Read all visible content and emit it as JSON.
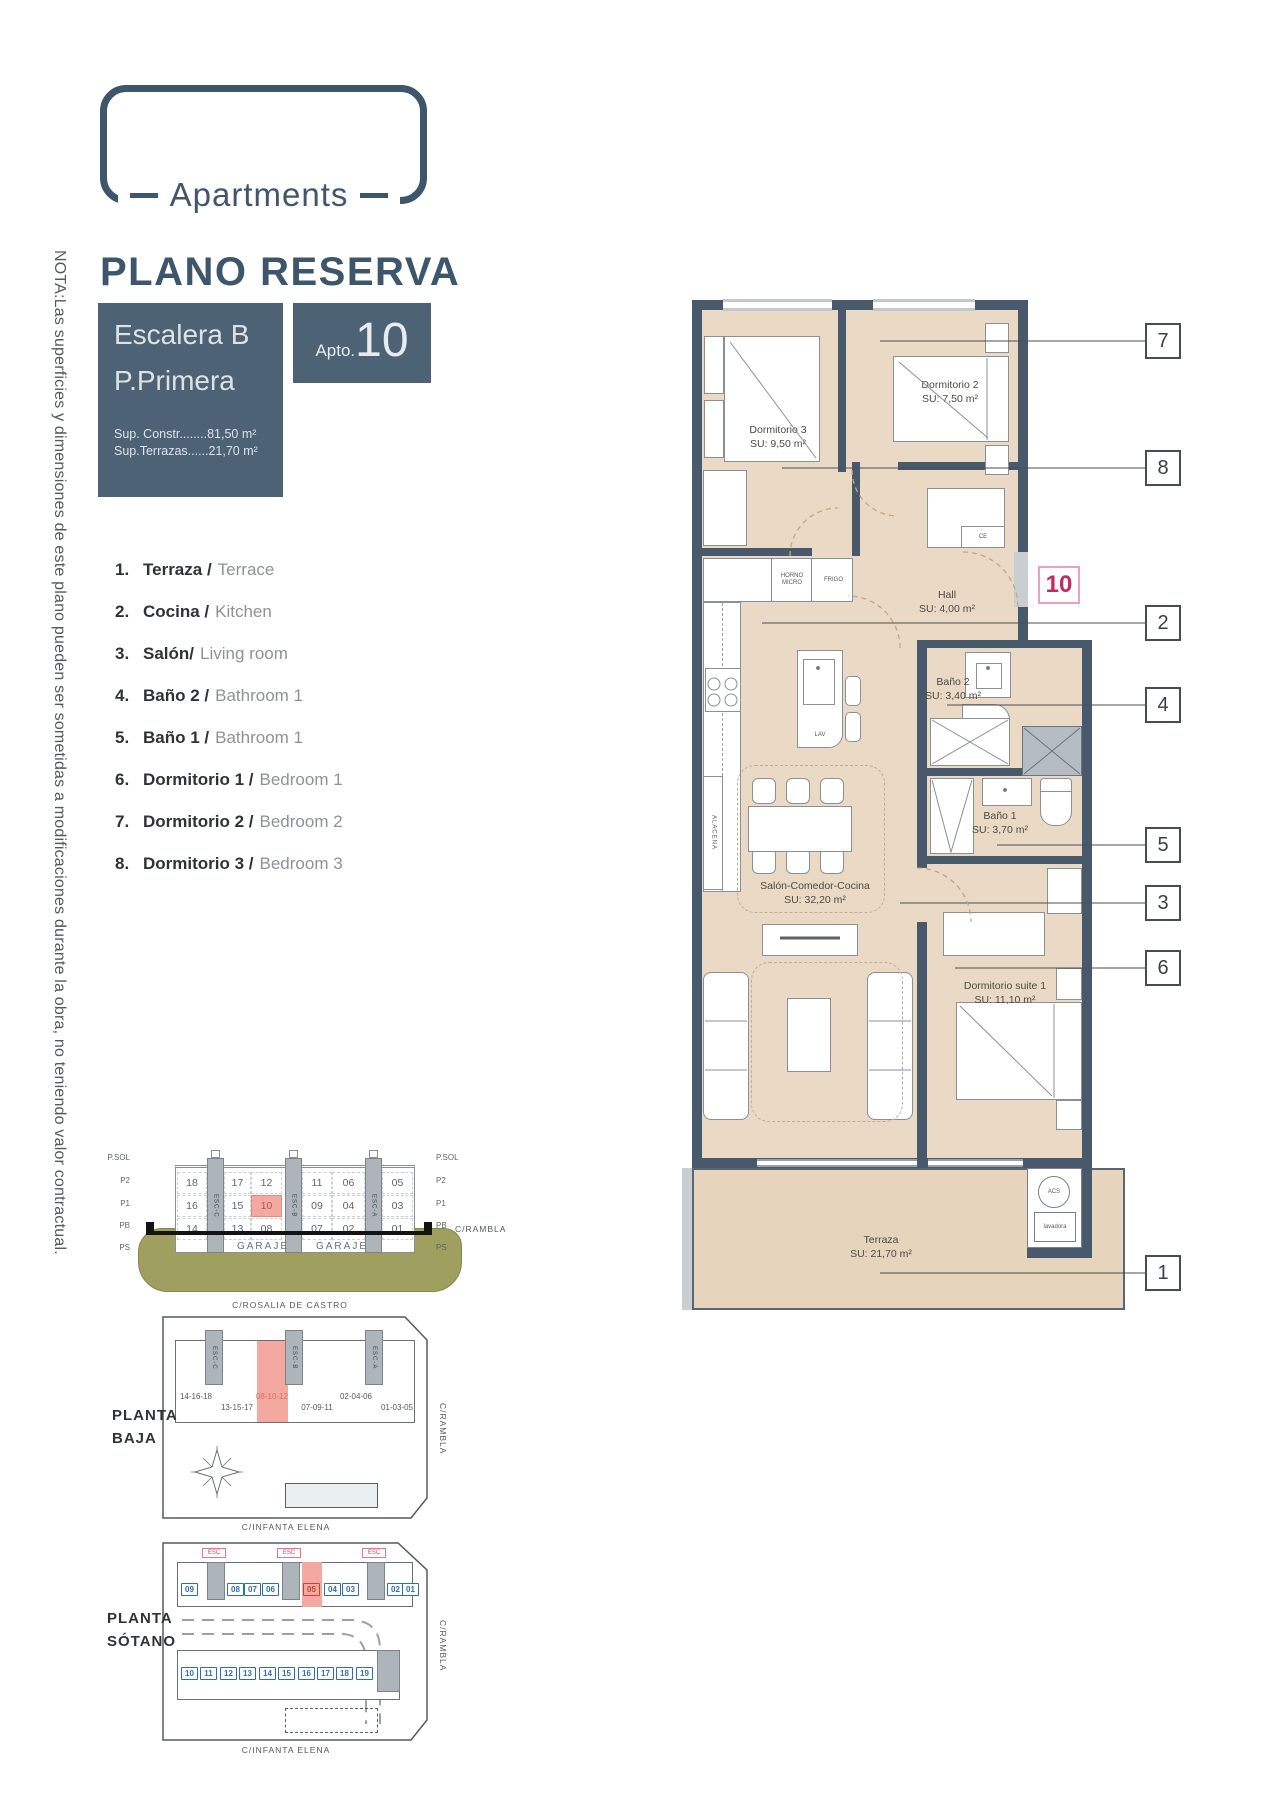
{
  "brand": {
    "logo_text": "Apartments",
    "title": "PLANO RESERVA"
  },
  "unit": {
    "escalera": "Escalera B",
    "planta": "P.Primera",
    "sup_constr": "Sup. Constr........81,50 m²",
    "sup_terrazas": "Sup.Terrazas......21,70 m²",
    "apto_label": "Apto.",
    "apto_number": "10"
  },
  "note": "NOTA:Las superficies y dimensiones de este plano pueden ser sometidas a modificaciones durante la obra, no teniendo valor contractual.",
  "legend": [
    {
      "n": "1.",
      "es": "Terraza /",
      "en": "Terrace"
    },
    {
      "n": "2.",
      "es": "Cocina /",
      "en": "Kitchen"
    },
    {
      "n": "3.",
      "es": "Salón/",
      "en": "Living room"
    },
    {
      "n": "4.",
      "es": "Baño 2 /",
      "en": "Bathroom 1"
    },
    {
      "n": "5.",
      "es": "Baño 1 /",
      "en": "Bathroom 1"
    },
    {
      "n": "6.",
      "es": "Dormitorio 1 /",
      "en": "Bedroom 1"
    },
    {
      "n": "7.",
      "es": "Dormitorio 2 /",
      "en": "Bedroom 2"
    },
    {
      "n": "8.",
      "es": "Dormitorio 3 /",
      "en": "Bedroom 3"
    }
  ],
  "plan": {
    "rooms": [
      {
        "name": "Dormitorio 3",
        "su": "SU: 9,50 m²"
      },
      {
        "name": "Dormitorio 2",
        "su": "SU: 7,50 m²"
      },
      {
        "name": "Hall",
        "su": "SU: 4,00 m²"
      },
      {
        "name": "Baño 2",
        "su": "SU: 3,40 m²"
      },
      {
        "name": "Baño 1",
        "su": "SU: 3,70 m²"
      },
      {
        "name": "Salón-Comedor-Cocina",
        "su": "SU: 32,20 m²"
      },
      {
        "name": "Dormitorio suite 1",
        "su": "SU: 11,10 m²"
      },
      {
        "name": "Terraza",
        "su": "SU: 21,70 m²"
      }
    ],
    "fixtures": {
      "horno": "HORNO MICRO",
      "frigo": "FRIGO",
      "lav": "LAV",
      "alacena": "ALACENA",
      "ce": "CE",
      "acs": "ACS",
      "lavadora": "lavadora"
    },
    "callouts": [
      "7",
      "8",
      "2",
      "4",
      "5",
      "3",
      "6",
      "1"
    ],
    "unit_number": "10"
  },
  "section": {
    "floors": [
      "P.SOL",
      "P2",
      "P1",
      "PB",
      "PS"
    ],
    "cores": [
      "ESC-C",
      "ESC-B",
      "ESC-A"
    ],
    "rows": [
      [
        "18",
        "17",
        "12",
        "11",
        "06",
        "05"
      ],
      [
        "16",
        "15",
        "10",
        "09",
        "04",
        "03"
      ],
      [
        "14",
        "13",
        "08",
        "07",
        "02",
        "01"
      ]
    ],
    "garaje": "GARAJE",
    "street": "C/RAMBLA"
  },
  "baja": {
    "title": "PLANTA BAJA",
    "street_top": "C/ROSALIA DE CASTRO",
    "street_bottom": "C/INFANTA ELENA",
    "street_right": "C/RAMBLA",
    "groups": [
      "14-16-18",
      "13-15-17",
      "08-10-12",
      "07-09-11",
      "02-04-06",
      "01-03-05"
    ]
  },
  "sotano": {
    "title": "PLANTA SÓTANO",
    "street_bottom": "C/INFANTA ELENA",
    "street_right": "C/RAMBLA",
    "core_tag": "ESC",
    "top_row": [
      "09",
      "08",
      "07",
      "06",
      "05",
      "04",
      "03",
      "02",
      "01"
    ],
    "bottom_row": [
      "10",
      "11",
      "12",
      "13",
      "14",
      "15",
      "16",
      "17",
      "18",
      "19"
    ]
  }
}
